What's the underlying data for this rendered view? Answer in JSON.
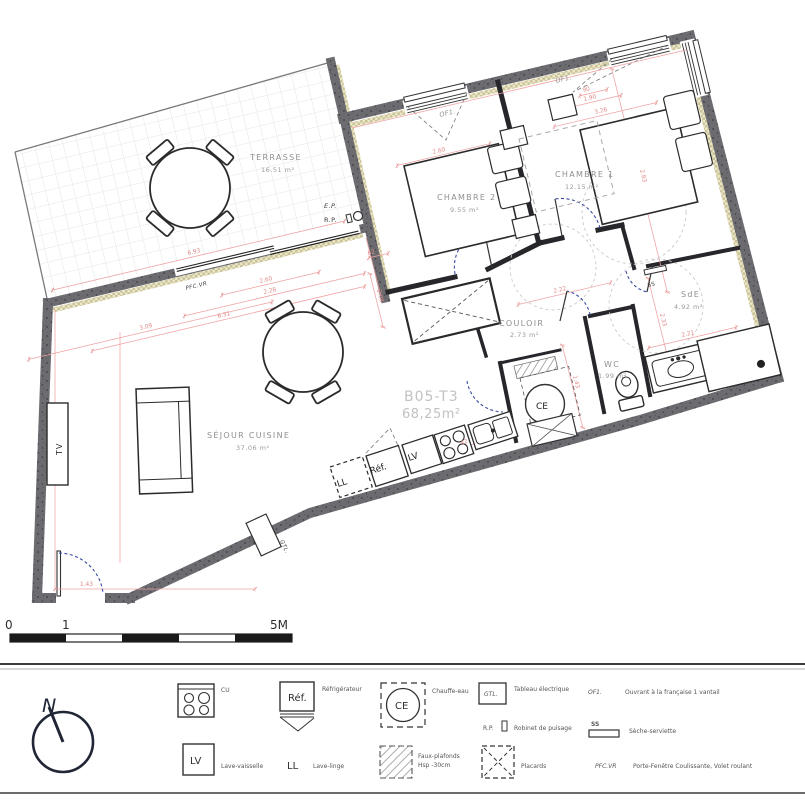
{
  "plan": {
    "unit": {
      "code": "B05-T3",
      "area": "68,25m²"
    },
    "rooms": [
      {
        "name": "TERRASSE",
        "area": "16.51 m²",
        "x": 250,
        "y": 160,
        "ax": 261,
        "ay": 172
      },
      {
        "name": "CHAMBRE 2",
        "area": "9.55 m²",
        "x": 437,
        "y": 200,
        "ax": 450,
        "ay": 212
      },
      {
        "name": "CHAMBRE 1",
        "area": "12.15 m²",
        "x": 555,
        "y": 177,
        "ax": 565,
        "ay": 189
      },
      {
        "name": "SdE",
        "area": "4.92 m²",
        "x": 681,
        "y": 297,
        "ax": 674,
        "ay": 309
      },
      {
        "name": "WC",
        "area": "1.99 m²",
        "x": 604,
        "y": 367,
        "ax": 598,
        "ay": 378
      },
      {
        "name": "COULOIR",
        "area": "2.73 m²",
        "x": 499,
        "y": 326,
        "ax": 510,
        "ay": 337
      },
      {
        "name": "SÉJOUR CUISINE",
        "area": "37.06 m²",
        "x": 207,
        "y": 438,
        "ax": 236,
        "ay": 450
      }
    ],
    "annotations": [
      {
        "n": "ep-label",
        "t": "E.P.",
        "x": 324,
        "y": 208,
        "cls": "ann i"
      },
      {
        "n": "rp-label",
        "t": "R.P.",
        "x": 324,
        "y": 222,
        "cls": "ann"
      },
      {
        "n": "pfc-vr-label",
        "t": "PFC.VR",
        "x": 186,
        "y": 290,
        "r": -13.3,
        "cls": "ann i sm"
      },
      {
        "n": "of1-chambre2",
        "t": "OF1.",
        "x": 440,
        "y": 117,
        "r": -13.3,
        "cls": "anng i"
      },
      {
        "n": "of1-chambre1",
        "t": "OF1.",
        "x": 556,
        "y": 83,
        "r": -13.3,
        "cls": "anng i"
      },
      {
        "n": "ss-label",
        "t": "SS",
        "x": 648,
        "y": 287,
        "r": -13.3,
        "cls": "ann sm"
      },
      {
        "n": "tv-label",
        "t": "TV",
        "x": 62,
        "y": 455,
        "r": -90,
        "cls": "dark"
      },
      {
        "n": "gtl-label",
        "t": "GTL.",
        "x": 280,
        "y": 541,
        "r": 65,
        "cls": "ann i sm"
      },
      {
        "n": "ll-label",
        "t": "LL",
        "x": 338,
        "y": 487,
        "r": -18,
        "cls": "app"
      },
      {
        "n": "ref-label",
        "t": "Réf.",
        "x": 371,
        "y": 474,
        "r": -18,
        "cls": "app"
      },
      {
        "n": "lv-label",
        "t": "LV",
        "x": 409,
        "y": 461,
        "r": -18,
        "cls": "app"
      },
      {
        "n": "ce-label",
        "t": "CE",
        "x": 536,
        "y": 409,
        "cls": "app"
      }
    ],
    "dimensions": [
      {
        "t": "6.93",
        "x": 188,
        "y": 255,
        "r": -13.3,
        "len": 300
      },
      {
        "t": "2.60",
        "x": 260,
        "y": 283,
        "r": -13.3,
        "len": 100
      },
      {
        "t": "2.28",
        "x": 264,
        "y": 294,
        "r": -13.3,
        "len": 185
      },
      {
        "t": "62",
        "x": 368,
        "y": 255,
        "r": -13.3,
        "len": 20
      },
      {
        "t": "2.08",
        "x": 377,
        "y": 290,
        "r": 76,
        "len": 55
      },
      {
        "t": "6.31",
        "x": 218,
        "y": 318,
        "r": -13.3,
        "len": 280
      },
      {
        "t": "3.09",
        "x": 140,
        "y": 330,
        "r": -13.3,
        "len": 250
      },
      {
        "t": "1.43",
        "x": 80,
        "y": 586,
        "r": 0,
        "len": 200,
        "cx": 155,
        "cy": 589
      },
      {
        "t": "2.60",
        "x": 433,
        "y": 154,
        "r": -13.3,
        "len": 95
      },
      {
        "t": "90",
        "x": 583,
        "y": 92,
        "r": -13.3,
        "len": 28
      },
      {
        "t": "1.90",
        "x": 584,
        "y": 101,
        "r": -13.3,
        "len": 55
      },
      {
        "t": "3.26",
        "x": 595,
        "y": 114,
        "r": -13.3,
        "len": 105
      },
      {
        "t": "2.83",
        "x": 640,
        "y": 170,
        "r": 76,
        "len": 230
      },
      {
        "t": "2.22",
        "x": 554,
        "y": 293,
        "r": -13.3,
        "len": 95
      },
      {
        "t": "2.33",
        "x": 660,
        "y": 314,
        "r": 76,
        "len": 95
      },
      {
        "t": "2.21",
        "x": 682,
        "y": 337,
        "r": -13.3,
        "len": 90
      },
      {
        "t": "1.43",
        "x": 573,
        "y": 376,
        "r": 76,
        "len": 85
      },
      {
        "t": "42",
        "x": 461,
        "y": 445,
        "r": -18,
        "len": 15
      }
    ]
  },
  "scale_bar": {
    "start": "0",
    "mid": "1",
    "end": "5M"
  },
  "north_label": "N",
  "legend": {
    "items": [
      {
        "sym": "",
        "label": "CU"
      },
      {
        "sym": "Réf.",
        "label": "Réfrigérateur"
      },
      {
        "sym": "CE",
        "label": "Chauffe-eau"
      },
      {
        "sym": "GTL.",
        "label": "Tableau électrique"
      },
      {
        "sym": "OF1.",
        "label": "Ouvrant à la française 1 vantail"
      },
      {
        "sym": "R.P.",
        "label": "Robinet de puisage"
      },
      {
        "sym": "SS",
        "label": "Sèche-serviette"
      },
      {
        "sym": "LV",
        "label": "Lave-vaisselle"
      },
      {
        "sym": "LL",
        "label": "Lave-linge"
      },
      {
        "sym": "",
        "label": "Faux-plafonds",
        "label2": "Hsp -30cm"
      },
      {
        "sym": "",
        "label": "Placards"
      },
      {
        "sym": "PFC.VR",
        "label": "Porte-Fenêtre Coulissante, Volet roulant"
      }
    ]
  }
}
